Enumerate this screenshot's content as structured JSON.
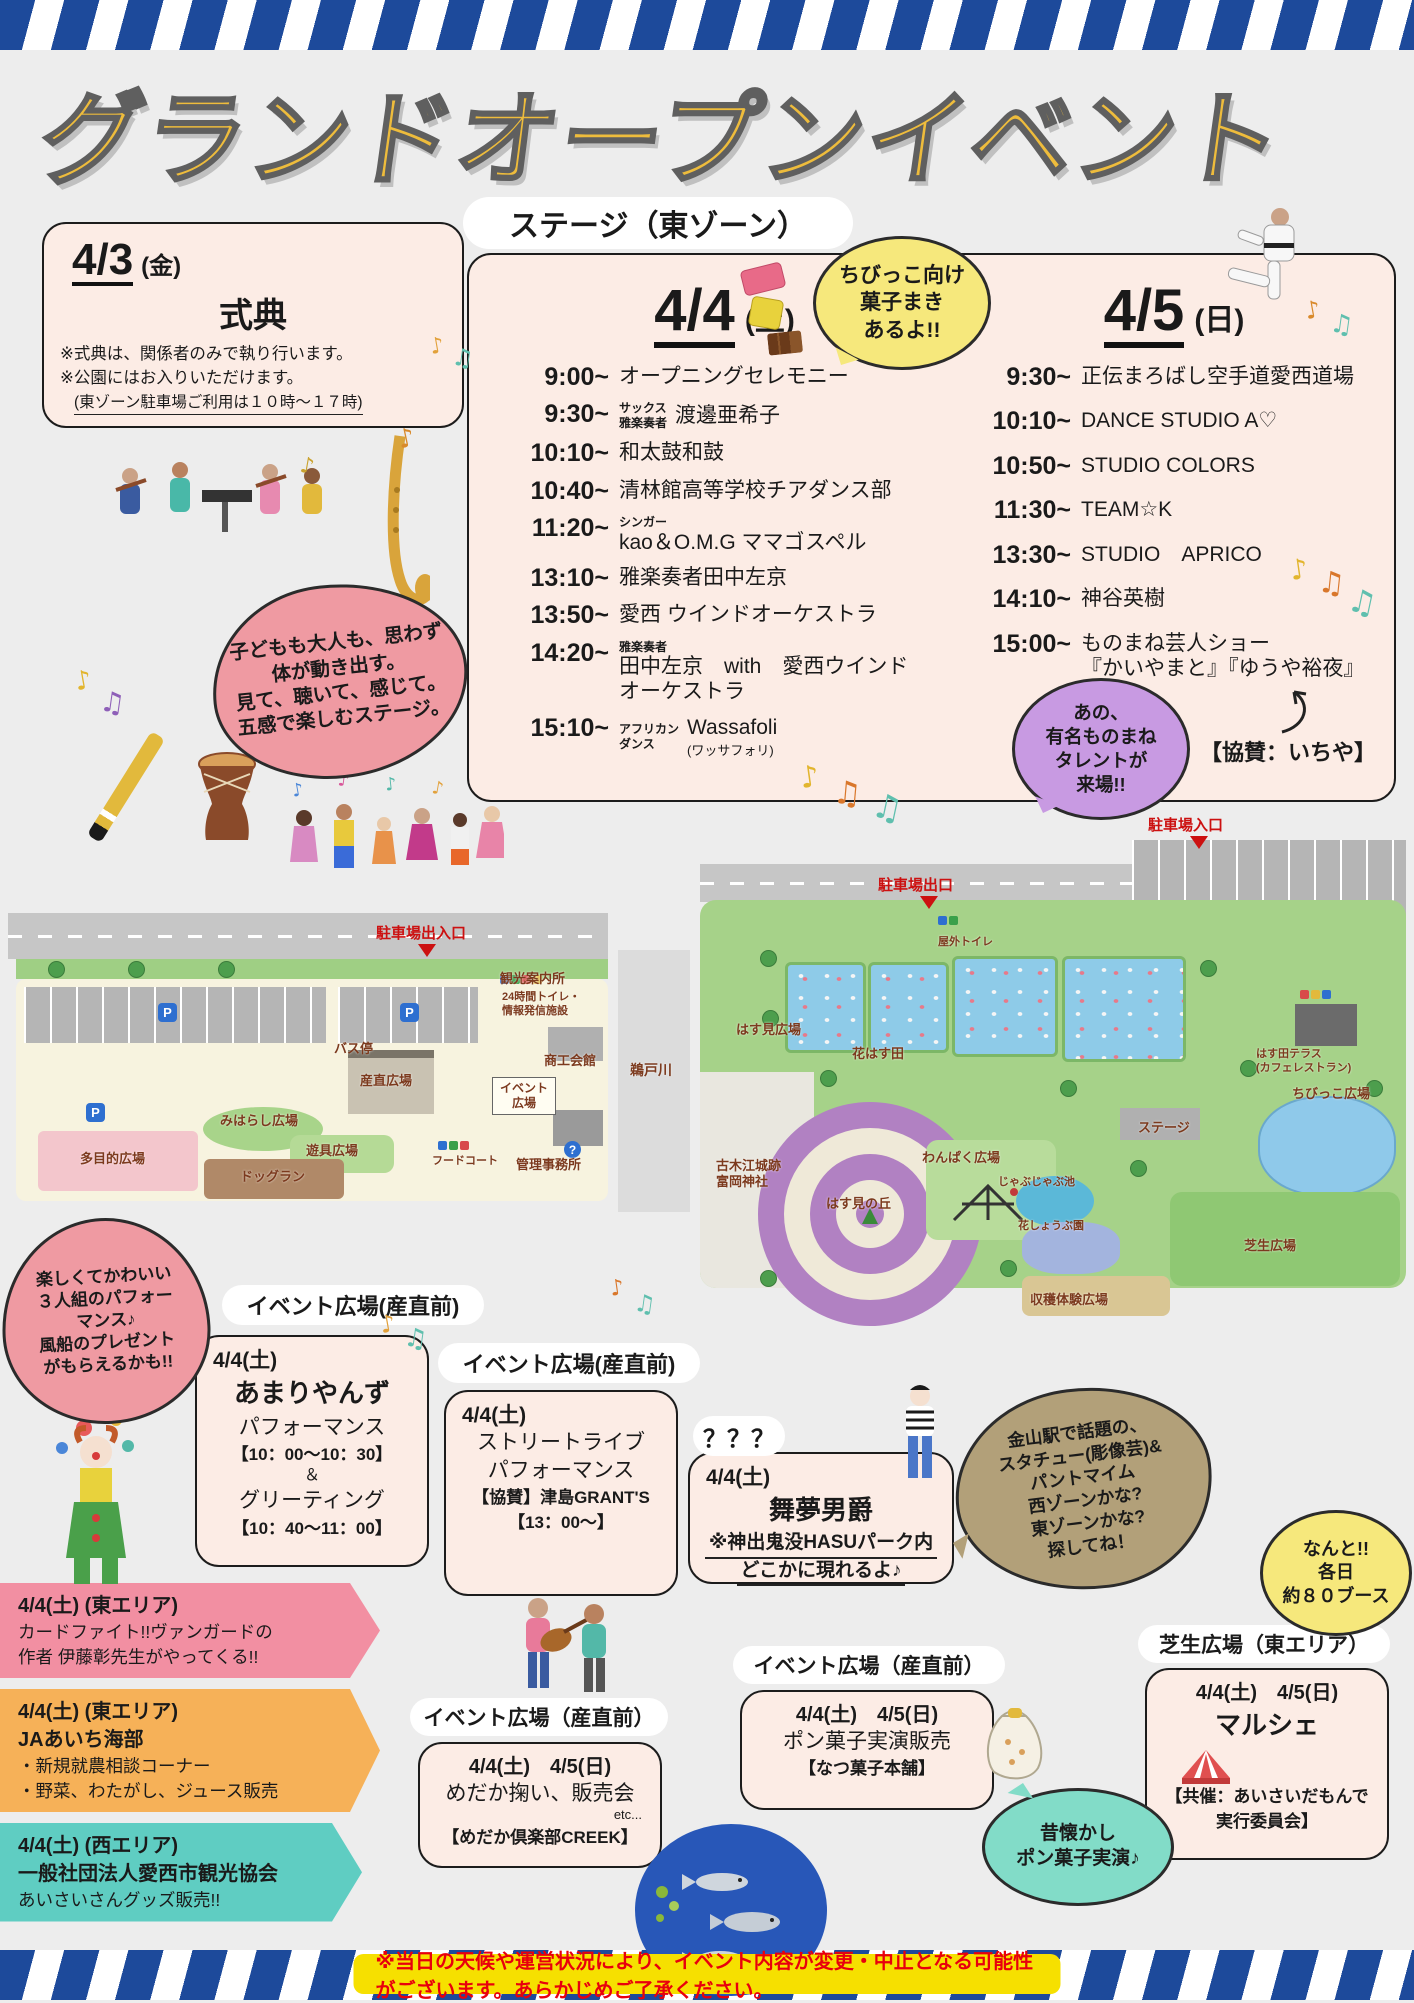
{
  "poster": {
    "title": "グランドオープンイベント",
    "stage_zone_label": "ステージ（東ゾーン）",
    "disclaimer": "※当日の天候や運営状況により、イベント内容が変更・中止となる可能性がございます。あらかじめご了承ください。"
  },
  "colors": {
    "stripe_navy": "#1d4a9b",
    "title_yellow": "#eebc3c",
    "box_pink": "#fcece5",
    "bubble_pink": "#ef9aa2",
    "bubble_yellow": "#f6e87c",
    "bubble_purple": "#c89ae2",
    "bubble_tan": "#b2a079",
    "bubble_teal": "#82dcc8",
    "ribbon_pink": "#f28fa2",
    "ribbon_orange": "#f6b158",
    "ribbon_teal": "#5fcdc2",
    "disclaimer_bg": "#f6e000",
    "disclaimer_text": "#e8000d"
  },
  "ceremony": {
    "date": "4/3",
    "day": "(金)",
    "title": "式典",
    "note1": "※式典は、関係者のみで執り行います。",
    "note2": "※公園にはお入りいただけます。",
    "note3": "(東ゾーン駐車場ご利用は１０時〜１７時)"
  },
  "stage": {
    "day1": {
      "date": "4/4",
      "day": "(土)",
      "rows": [
        {
          "time": "9:00~",
          "act": "オープニングセレモニー"
        },
        {
          "time": "9:30~",
          "pre": "サックス\n雅楽奏者",
          "mode": "side",
          "act": "渡邊亜希子"
        },
        {
          "time": "10:10~",
          "act": "和太鼓和鼓"
        },
        {
          "time": "10:40~",
          "act": "清林館高等学校チアダンス部"
        },
        {
          "time": "11:20~",
          "pre": "シンガー",
          "mode": "top",
          "act": "kao＆O.M.G ママゴスペル"
        },
        {
          "time": "13:10~",
          "act": "雅楽奏者田中左京"
        },
        {
          "time": "13:50~",
          "act": "愛西 ウインドオーケストラ"
        },
        {
          "time": "14:20~",
          "pre": "雅楽奏者",
          "mode": "top",
          "act": "田中左京　with　愛西ウインド\nオーケストラ"
        },
        {
          "time": "15:10~",
          "pre": "アフリカン\nダンス",
          "mode": "side",
          "act": "Wassafoli",
          "small": "(ワッサフォリ)"
        }
      ]
    },
    "day2": {
      "date": "4/5",
      "day": "(日)",
      "rows": [
        {
          "time": "9:30~",
          "act": "正伝まろばし空手道愛西道場"
        },
        {
          "time": "10:10~",
          "act": "DANCE STUDIO A♡"
        },
        {
          "time": "10:50~",
          "act": "STUDIO COLORS"
        },
        {
          "time": "11:30~",
          "act": "TEAM☆K"
        },
        {
          "time": "13:30~",
          "act": "STUDIO　APRICO"
        },
        {
          "time": "14:10~",
          "act": "神谷英樹"
        },
        {
          "time": "15:00~",
          "act": "ものまね芸人ショー\n『かいやまと』『ゆうや裕夜』"
        }
      ]
    },
    "sponsor": "【協賛：いちや】"
  },
  "bubbles": {
    "candy": "ちびっこ向け\n菓子まき\nあるよ!!",
    "stage_feel": "子どもも大人も、思わず\n体が動き出す。\n見て、聴いて、感じて。\n五感で楽しむステージ。",
    "monomane": "あの、\n有名ものまね\nタレントが\n来場!!",
    "trio": "楽しくてかわいい\n３人組のパフォー\nマンス♪\n風船のプレゼント\nがもらえるかも!!",
    "statue": "金山駅で話題の、\nスタチュー(彫像芸)&\nパントマイム\n西ゾーンかな?\n東ゾーンかな?\n探してね！",
    "booths": "なんと!!\n各日\n約８０ブース",
    "ponkashi_old": "昔懐かし\nポン菓子実演♪"
  },
  "maps": {
    "west": {
      "entrance": "駐車場出入口",
      "river": "鵜戸川",
      "labels": [
        {
          "t": "バス停",
          "x": 326,
          "y": 136
        },
        {
          "t": "観光案内所",
          "x": 492,
          "y": 66
        },
        {
          "t": "24時間トイレ・\n情報発信施設",
          "x": 494,
          "y": 86,
          "cls": "tiny"
        },
        {
          "t": "産直広場",
          "x": 352,
          "y": 168
        },
        {
          "t": "イベント\n広場",
          "x": 484,
          "y": 172,
          "cls": "boxed"
        },
        {
          "t": "商工会館",
          "x": 536,
          "y": 148
        },
        {
          "t": "みはらし広場",
          "x": 212,
          "y": 208
        },
        {
          "t": "遊具広場",
          "x": 298,
          "y": 238
        },
        {
          "t": "多目的広場",
          "x": 72,
          "y": 246
        },
        {
          "t": "ドッグラン",
          "x": 232,
          "y": 264
        },
        {
          "t": "フードコート",
          "x": 424,
          "y": 250,
          "cls": "tiny"
        },
        {
          "t": "管理事務所",
          "x": 508,
          "y": 252
        }
      ]
    },
    "east": {
      "entrance_in": "駐車場入口",
      "entrance_out": "駐車場出口",
      "labels": [
        {
          "t": "屋外トイレ",
          "x": 238,
          "y": 96,
          "cls": "tiny"
        },
        {
          "t": "はす見広場",
          "x": 36,
          "y": 182
        },
        {
          "t": "花はす田",
          "x": 152,
          "y": 206
        },
        {
          "t": "はす田テラス\n(カフェレストラン)",
          "x": 556,
          "y": 208,
          "cls": "tiny"
        },
        {
          "t": "ちびっこ広場",
          "x": 592,
          "y": 246
        },
        {
          "t": "ステージ",
          "x": 438,
          "y": 280
        },
        {
          "t": "古木江城跡\n富岡神社",
          "x": 16,
          "y": 318
        },
        {
          "t": "わんぱく広場",
          "x": 222,
          "y": 310
        },
        {
          "t": "じゃぶじゃぶ池",
          "x": 298,
          "y": 336,
          "cls": "tiny"
        },
        {
          "t": "花しょうぶ園",
          "x": 318,
          "y": 380,
          "cls": "tiny"
        },
        {
          "t": "はす見の丘",
          "x": 126,
          "y": 356
        },
        {
          "t": "芝生広場",
          "x": 544,
          "y": 398
        },
        {
          "t": "収穫体験広場",
          "x": 330,
          "y": 452
        }
      ]
    }
  },
  "sections": {
    "amari": {
      "pill": "イベント広場(産直前)",
      "lines": [
        {
          "t": "4/4(土)",
          "cls": "date-left"
        },
        {
          "t": "あまりやんず",
          "cls": "big"
        },
        {
          "t": "パフォーマンス",
          "cls": "mid"
        },
        {
          "t": "【10：00〜10：30】",
          "cls": "time"
        },
        {
          "t": "＆",
          "cls": "amp"
        },
        {
          "t": "グリーティング",
          "cls": "mid"
        },
        {
          "t": "【10：40〜11：00】",
          "cls": "time"
        }
      ]
    },
    "street": {
      "pill": "イベント広場(産直前)",
      "lines": [
        {
          "t": "4/4(土)",
          "cls": "date-left"
        },
        {
          "t": "ストリートライブ",
          "cls": "mid"
        },
        {
          "t": "パフォーマンス",
          "cls": "mid"
        },
        {
          "t": "【協賛】津島GRANT'S",
          "cls": "time"
        },
        {
          "t": "【13：00〜】",
          "cls": "time"
        }
      ]
    },
    "mystery": {
      "pill": "？？？",
      "lines": [
        {
          "t": "4/4(土)",
          "cls": "date-left"
        },
        {
          "t": "舞夢男爵",
          "cls": "big"
        },
        {
          "t": "※神出鬼没HASUパーク内",
          "cls": "underline"
        },
        {
          "t": "どこかに現れるよ♪",
          "cls": "underline"
        }
      ]
    },
    "medaka": {
      "pill": "イベント広場（産直前）",
      "lines": [
        {
          "t": "4/4(土)　4/5(日)",
          "cls": "date-c"
        },
        {
          "t": "めだか掬い、販売会",
          "cls": "mid"
        },
        {
          "t": "etc...",
          "cls": "etc"
        },
        {
          "t": "【めだか倶楽部CREEK】",
          "cls": "time"
        }
      ]
    },
    "ponkashi": {
      "pill": "イベント広場（産直前）",
      "lines": [
        {
          "t": "4/4(土)　4/5(日)",
          "cls": "date-c"
        },
        {
          "t": "ポン菓子実演販売",
          "cls": "mid"
        },
        {
          "t": "【なつ菓子本舗】",
          "cls": "time"
        }
      ]
    },
    "marche": {
      "pill": "芝生広場（東エリア）",
      "lines": [
        {
          "t": "4/4(土)　4/5(日)",
          "cls": "date-c"
        },
        {
          "t": "マルシェ",
          "cls": "big"
        },
        {
          "t": "【共催：あいさいだもんで",
          "cls": "time mt"
        },
        {
          "t": "実行委員会】",
          "cls": "time"
        }
      ]
    }
  },
  "ribbons": [
    {
      "color": "pink",
      "lines": [
        {
          "t": "4/4(土) (東エリア)",
          "cls": "r-date"
        },
        {
          "t": "カードファイト!!ヴァンガードの",
          "cls": "r-normal"
        },
        {
          "t": "作者 伊藤彰先生がやってくる!!",
          "cls": "r-normal"
        }
      ]
    },
    {
      "color": "orange",
      "lines": [
        {
          "t": "4/4(土) (東エリア)",
          "cls": "r-date"
        },
        {
          "t": "JAあいち海部",
          "cls": "r-bold"
        },
        {
          "t": "・新規就農相談コーナー",
          "cls": "r-normal"
        },
        {
          "t": "・野菜、わたがし、ジュース販売",
          "cls": "r-normal"
        }
      ]
    },
    {
      "color": "teal",
      "lines": [
        {
          "t": "4/4(土) (西エリア)",
          "cls": "r-date"
        },
        {
          "t": "一般社団法人愛西市観光協会",
          "cls": "r-bold"
        },
        {
          "t": "あいさいさんグッズ販売!!",
          "cls": "r-normal"
        }
      ]
    }
  ],
  "deco": {
    "notes": [
      {
        "x": 430,
        "y": 334,
        "g": "♪",
        "c": "#e2a13b",
        "s": 22,
        "r": -10
      },
      {
        "x": 452,
        "y": 344,
        "g": "♫",
        "c": "#5fbfae",
        "s": 24,
        "r": 8
      },
      {
        "x": 398,
        "y": 424,
        "g": "♪",
        "c": "#d98a2b",
        "s": 26,
        "r": -12
      },
      {
        "x": 300,
        "y": 454,
        "g": "♪",
        "c": "#caa22e",
        "s": 22,
        "r": 10
      },
      {
        "x": 1305,
        "y": 296,
        "g": "♪",
        "c": "#d98a2b",
        "s": 24,
        "r": -10
      },
      {
        "x": 1330,
        "y": 310,
        "g": "♫",
        "c": "#5fbfae",
        "s": 26,
        "r": 8
      },
      {
        "x": 1290,
        "y": 553,
        "g": "♪",
        "c": "#e2b52e",
        "s": 28,
        "r": -8
      },
      {
        "x": 1318,
        "y": 566,
        "g": "♫",
        "c": "#d9772b",
        "s": 30,
        "r": 6
      },
      {
        "x": 1348,
        "y": 583,
        "g": "♫",
        "c": "#5fbfae",
        "s": 32,
        "r": 12
      },
      {
        "x": 75,
        "y": 666,
        "g": "♪",
        "c": "#e2b52e",
        "s": 26,
        "r": -10
      },
      {
        "x": 100,
        "y": 686,
        "g": "♫",
        "c": "#8e5fb8",
        "s": 28,
        "r": 8
      },
      {
        "x": 800,
        "y": 760,
        "g": "♪",
        "c": "#e2b52e",
        "s": 30,
        "r": -8
      },
      {
        "x": 833,
        "y": 774,
        "g": "♫",
        "c": "#d9772b",
        "s": 32,
        "r": 5
      },
      {
        "x": 872,
        "y": 788,
        "g": "♫",
        "c": "#5fbfae",
        "s": 34,
        "r": 12
      },
      {
        "x": 292,
        "y": 780,
        "g": "♪",
        "c": "#4a86d8",
        "s": 18,
        "r": -10
      },
      {
        "x": 338,
        "y": 770,
        "g": "♪",
        "c": "#d8579a",
        "s": 18,
        "r": 8
      },
      {
        "x": 385,
        "y": 774,
        "g": "♪",
        "c": "#53b8a8",
        "s": 18,
        "r": -6
      },
      {
        "x": 432,
        "y": 778,
        "g": "♪",
        "c": "#e2a13b",
        "s": 18,
        "r": 10
      },
      {
        "x": 380,
        "y": 1310,
        "g": "♪",
        "c": "#e2a13b",
        "s": 24,
        "r": -10
      },
      {
        "x": 404,
        "y": 1324,
        "g": "♫",
        "c": "#5fbfae",
        "s": 26,
        "r": 8
      },
      {
        "x": 610,
        "y": 1276,
        "g": "♪",
        "c": "#d9772b",
        "s": 22,
        "r": -8
      },
      {
        "x": 634,
        "y": 1290,
        "g": "♫",
        "c": "#5fbfae",
        "s": 24,
        "r": 8
      }
    ]
  }
}
